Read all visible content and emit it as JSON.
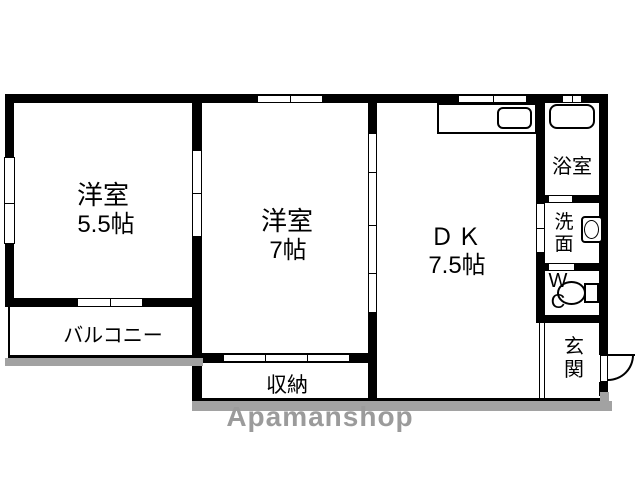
{
  "floorplan": {
    "type": "apartment-floor-plan",
    "rooms": {
      "room1_name": "洋室",
      "room1_size": "5.5帖",
      "room2_name": "洋室",
      "room2_size": "7帖",
      "dk_name": "ＤＫ",
      "dk_size": "7.5帖",
      "bath": "浴室",
      "washroom": "洗\n面",
      "wc": "W\nC",
      "entrance": "玄\n関",
      "storage": "収納",
      "balcony": "バルコニー"
    },
    "fixtures": [
      "kitchen-counter",
      "kitchen-sink",
      "bathtub",
      "washbasin",
      "toilet",
      "entrance-door"
    ],
    "colors": {
      "wall": "#000000",
      "background": "#ffffff",
      "shadow": "#a2a2a2",
      "watermark": "#9b9b9b"
    }
  },
  "watermark": {
    "text": "Apamanshop"
  }
}
